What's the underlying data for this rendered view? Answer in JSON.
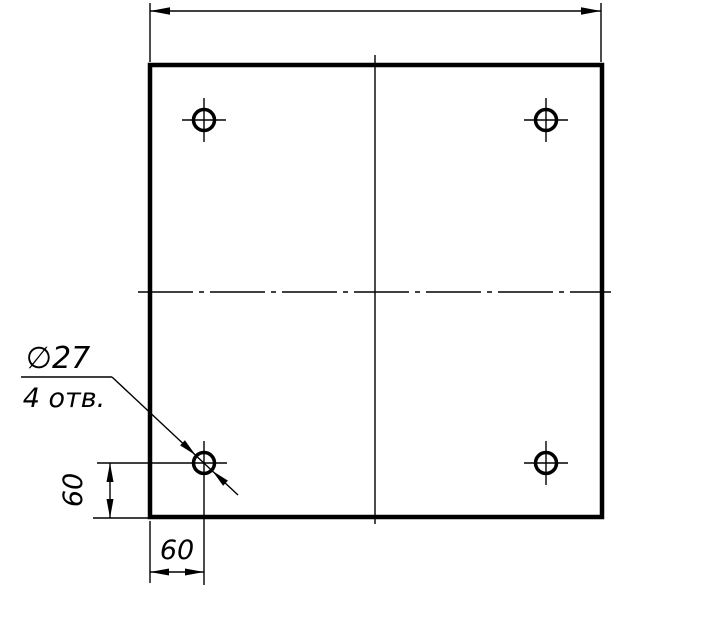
{
  "drawing": {
    "kind": "engineering-drawing",
    "description": "Square plate, face view, with four drilled holes near the corners",
    "colors": {
      "line": "#000000",
      "background": "#ffffff"
    },
    "callout": {
      "diameter_label": "∅27",
      "count_label": "4 отв."
    },
    "dimensions": {
      "vertical_offset_label": "60",
      "horizontal_offset_label": "60"
    },
    "geometry": {
      "hole_count": 4,
      "hole_diameter_mm": 27,
      "hole_offset_from_bottom_mm": 60,
      "hole_offset_from_left_mm": 60,
      "plate_px": {
        "left": 150,
        "top": 65,
        "right": 602,
        "bottom": 517
      },
      "holes_px": [
        {
          "cx": 204,
          "cy": 120
        },
        {
          "cx": 546,
          "cy": 120
        },
        {
          "cx": 204,
          "cy": 463
        },
        {
          "cx": 546,
          "cy": 463
        }
      ],
      "hole_radius_px": 10.5
    }
  }
}
